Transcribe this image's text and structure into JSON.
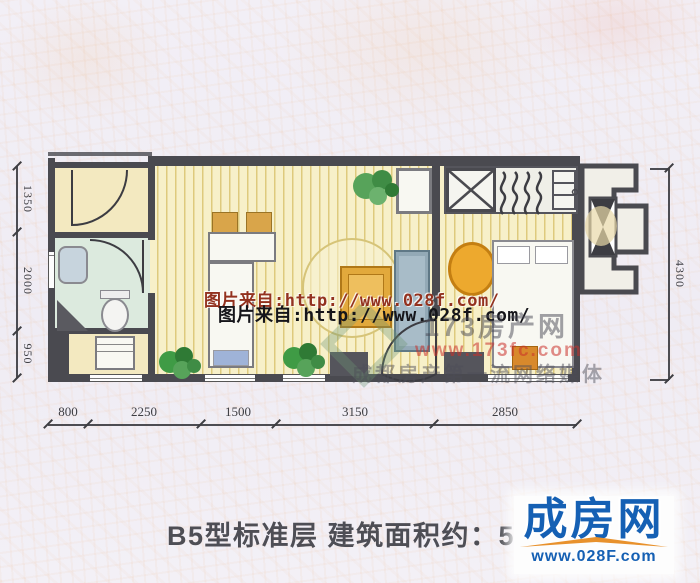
{
  "watermarks": {
    "line1": "图片来自:http://www.028f.com/",
    "line2": "图片来自:http://www.028f.com/",
    "agency_name": "173房产网",
    "agency_url": "www.173fc.com",
    "agency_slogan": "成都房产第一流网络媒体"
  },
  "dims": {
    "bottom": [
      "800",
      "2250",
      "1500",
      "3150",
      "2850"
    ],
    "left": [
      "1350",
      "2000",
      "950"
    ],
    "right": [
      "4300"
    ]
  },
  "caption": {
    "title": "B5型标准层 建筑面积约：55m",
    "area_superscript": "2"
  },
  "logo": {
    "name": "成房网",
    "url": "www.028F.com"
  },
  "colors": {
    "wall": "#4a4a50",
    "wood_floor": "#f7f0c9",
    "bathroom_floor": "#dceade",
    "watermark_red": "#93321f",
    "logo_blue": "#1560b4",
    "logo_orange": "#e8912c"
  }
}
